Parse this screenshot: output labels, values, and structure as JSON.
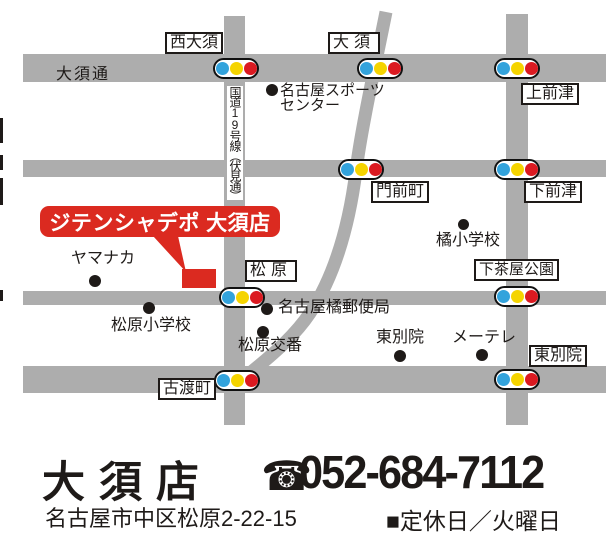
{
  "colors": {
    "road_gray": "#adadad",
    "signal_blue": "#33a3dc",
    "signal_yellow": "#f5d400",
    "signal_red": "#db1a21",
    "banner_red": "#db2a20",
    "text_black": "#1e1a18"
  },
  "map": {
    "route_labels": {
      "osu_dori": "大須通",
      "route19": "国道19号線（伏見通）"
    },
    "intersection_labels": [
      {
        "id": "nishi-osu",
        "text": "西大須"
      },
      {
        "id": "osu",
        "text": "大須"
      },
      {
        "id": "kamimaezu",
        "text": "上前津"
      },
      {
        "id": "monzencho",
        "text": "門前町"
      },
      {
        "id": "shimomaezu",
        "text": "下前津"
      },
      {
        "id": "matsubara",
        "text": "松原"
      },
      {
        "id": "shimochaya-koen",
        "text": "下茶屋公園"
      },
      {
        "id": "higashi-betsuin",
        "text": "東別院"
      },
      {
        "id": "furuwatari-cho",
        "text": "古渡町"
      }
    ],
    "pois": [
      {
        "id": "nagoya-sports-center",
        "line1": "名古屋スポーツ",
        "line2": "センター"
      },
      {
        "id": "tachibana-elementary",
        "text": "橘小学校"
      },
      {
        "id": "yamanaka",
        "text": "ヤマナカ"
      },
      {
        "id": "matsubara-elementary",
        "text": "松原小学校"
      },
      {
        "id": "nagoya-tachibana-post-office",
        "text": "名古屋橘郵便局"
      },
      {
        "id": "matsubara-koban",
        "text": "松原交番"
      },
      {
        "id": "higashi-betsuin-temple",
        "text": "東別院"
      },
      {
        "id": "me-tele",
        "text": "メーテレ"
      }
    ],
    "store_banner": "ジテンシャデポ 大須店"
  },
  "footer": {
    "store_name": "大須店",
    "phone_icon": "☎",
    "phone_number": "052-684-7112",
    "address": "名古屋市中区松原2-22-15",
    "closed_day": "■定休日／火曜日"
  }
}
